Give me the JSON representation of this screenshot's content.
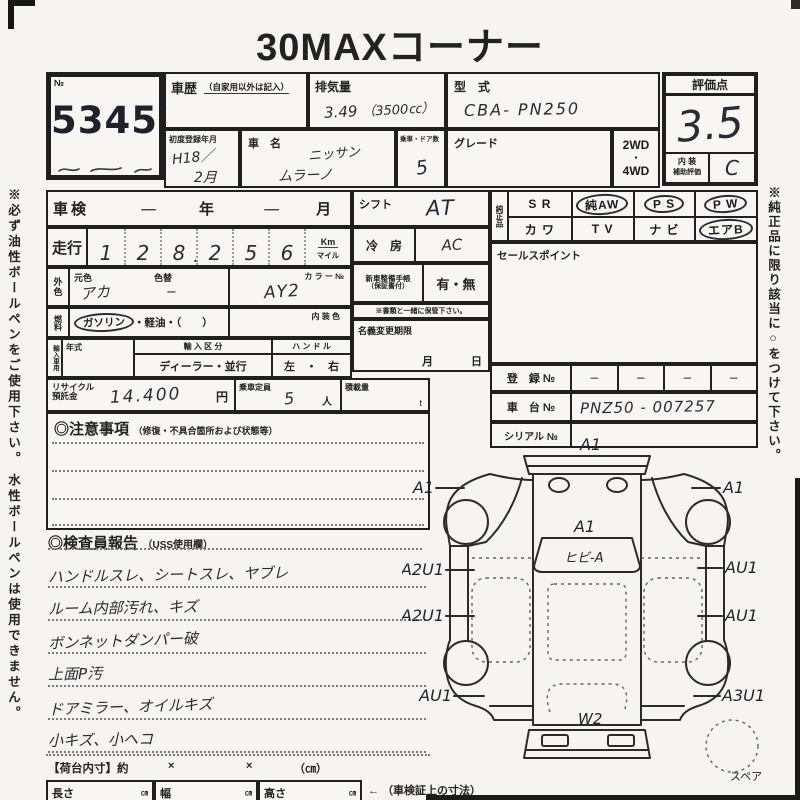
{
  "colors": {
    "paper": "#f5f4f0",
    "ink": "#1b1b1b",
    "handwriting": "#2a2b33"
  },
  "title": "30MAXコーナー",
  "side_notes": {
    "left": "※必ず油性ボールペンをご使用下さい。 水性ボールペンは使用できません。",
    "right": "※純正品に限り該当に○をつけて下さい。"
  },
  "auction": {
    "no_label": "№",
    "number": "53457"
  },
  "header": {
    "shareki_label": "車歴",
    "shareki_note": "（自家用以外は記入）",
    "haiki_label": "排気量",
    "haiki_value": "3.49",
    "haiki_paren": "（3500㏄）",
    "katashiki_label": "型　式",
    "katashiki_value": "CBA- PN250",
    "reg_label": "初度登録年月",
    "reg_value_1": "H18／",
    "reg_value_2": "2月",
    "name_label": "車　名",
    "name_value_1": "ニッサン",
    "name_value_2": "ムラーノ",
    "doors_label": "乗車・ドア数",
    "doors_value": "5",
    "grade_label": "グレード",
    "drive_1": "2WD",
    "drive_dot": "・",
    "drive_2": "4WD",
    "score_label": "評価点",
    "score_value": "3.5",
    "interior_label_1": "内 装",
    "interior_label_2": "補助評価",
    "interior_value": "C"
  },
  "left": {
    "shaken_label": "車検",
    "shaken_year": "一",
    "year_unit": "年",
    "shaken_month": "一",
    "month_unit": "月",
    "soko_label": "走行",
    "digits": [
      "1",
      "2",
      "8",
      "2",
      "5",
      "6"
    ],
    "decimal": ".",
    "unit_km": "Km",
    "unit_mile": "マイル",
    "gaishoku_label": "外色",
    "motoiro_label": "元色",
    "motoiro_value": "アカ",
    "iroka_label": "色替",
    "iroka_value": "−",
    "colorno_label": "カ ラ ー №",
    "colorno_value": "AY2",
    "fuel_label": "燃料",
    "fuel_gasoline": "ガソリン",
    "fuel_rest": "・軽油・（　　）",
    "naiso_label": "内 装 色",
    "import_label": "輸入車用",
    "nenshiki_label": "年式",
    "kubun_label": "輸 入 区 分",
    "kubun_value": "ディーラー・並行",
    "handle_label": "ハ ン ド ル",
    "handle_value": "左　・　右",
    "recycle_label_1": "リサイクル",
    "recycle_label_2": "預託金",
    "recycle_value": "14.400",
    "recycle_unit": "円",
    "teiin_label": "乗車定員",
    "teiin_value": "5",
    "teiin_unit": "人",
    "sekisai_label": "積載量",
    "sekisai_unit": "t"
  },
  "middle": {
    "shift_label": "シフト",
    "shift_value": "AT",
    "ac_label": "冷　房",
    "ac_value": "AC",
    "techo_label_1": "新車整備手帳",
    "techo_label_2": "（保証書付）",
    "techo_value": "有・無",
    "keep_note": "※書類と一緒に保管下さい。",
    "meigi_label": "名義変更期限",
    "meigi_month": "月",
    "meigi_day": "日"
  },
  "equipment": {
    "label": "純正品",
    "items": [
      {
        "label": "S R",
        "circled": false
      },
      {
        "label": "純AW",
        "circled": true
      },
      {
        "label": "P S",
        "circled": true
      },
      {
        "label": "P W",
        "circled": true
      },
      {
        "label": "カ ワ",
        "circled": false
      },
      {
        "label": "T V",
        "circled": false
      },
      {
        "label": "ナ ビ",
        "circled": false
      },
      {
        "label": "エアB",
        "circled": true
      }
    ]
  },
  "sales": {
    "label": "セールスポイント",
    "value": ""
  },
  "registration": {
    "toroku_label": "登　録 №",
    "toroku_values": [
      "−",
      "−",
      "−",
      "−"
    ],
    "shadai_label": "車　台 №",
    "shadai_value": "PNZ50 - 007257",
    "serial_label": "シリアル №",
    "serial_value": ""
  },
  "chui": {
    "title": "◎注意事項",
    "sub": "（修復・不具合箇所および状態等）"
  },
  "inspector": {
    "title": "◎検査員報告",
    "sub": "（USS使用欄）",
    "lines": [
      "ハンドルスレ、シートスレ、ヤブレ",
      "ルーム内部汚れ、キズ",
      "ボンネットダンパー破",
      "上面P汚",
      "ドアミラー、オイルキズ",
      "小キズ、小ヘコ"
    ]
  },
  "diagram": {
    "labels": {
      "a1_top": "A1",
      "a1_left": "A1",
      "a1_right": "A1",
      "a1_hood": "A1",
      "windshield": "ヒビ-A",
      "a2u1_upper": "A2U1",
      "a2u1_lower": "A2U1",
      "au1_r_upper": "AU1",
      "au1_r_lower": "AU1",
      "au1_rear_left": "AU1",
      "a3u1_rear_right": "A3U1",
      "w2": "W2",
      "a2_bottom": "A2",
      "spare": "スペア"
    }
  },
  "footer": {
    "nidai": "【荷台内寸】約",
    "x1": "×",
    "x2": "×",
    "cm": "（㎝）",
    "len_label": "長さ",
    "len_unit": "㎝",
    "wid_label": "幅",
    "wid_unit": "㎝",
    "hei_label": "高さ",
    "hei_unit": "㎝",
    "arrow": "←",
    "note": "（車検証上の寸法）"
  }
}
